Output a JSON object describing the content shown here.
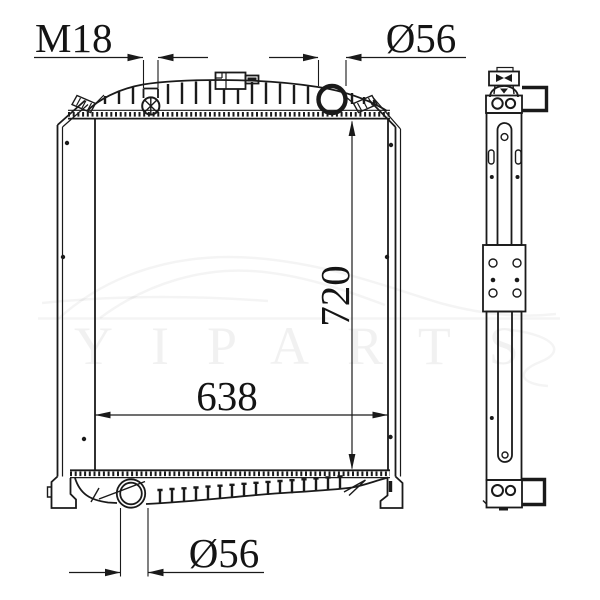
{
  "drawing": {
    "subject": "radiator-two-view-engineering-drawing",
    "background": "#ffffff",
    "line_color": "#1a1a1a",
    "watermark": {
      "text": "YIPARTS",
      "opacity": "0.05"
    },
    "dimensions": {
      "filler_thread": "M18",
      "top_pipe_diameter": "Ø56",
      "core_height": "720",
      "core_width": "638",
      "bottom_pipe_diameter": "Ø56"
    }
  }
}
